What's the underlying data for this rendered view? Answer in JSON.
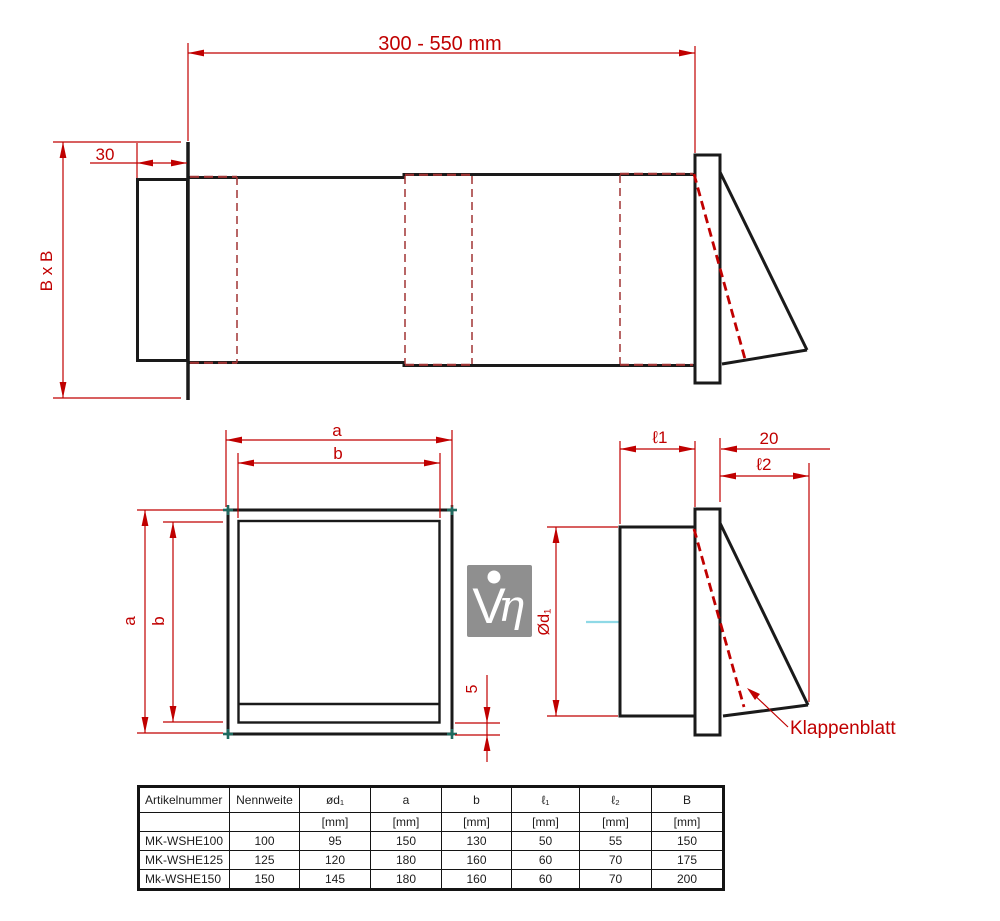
{
  "drawing": {
    "top_view": {
      "length_dim": "300 - 550 mm",
      "flange_dim": "30",
      "duct_dim": "B x B"
    },
    "front_view": {
      "outer_width_dim": "a",
      "inner_width_dim": "b",
      "outer_height_dim": "a",
      "inner_height_dim": "b",
      "gap_dim": "5"
    },
    "side_view": {
      "diameter_dim": "Ød₁",
      "l1_dim": "ℓ1",
      "plate_dim": "20",
      "l2_dim": "ℓ2",
      "flap_label": "Klappenblatt"
    }
  },
  "logo": {
    "letter_v": "V",
    "letter_eta": "η"
  },
  "table": {
    "headers": [
      "Artikelnummer",
      "Nennweite",
      "ød₁",
      "a",
      "b",
      "ℓ₁",
      "ℓ₂",
      "B"
    ],
    "units": [
      "",
      "",
      "[mm]",
      "[mm]",
      "[mm]",
      "[mm]",
      "[mm]",
      "[mm]"
    ],
    "rows": [
      [
        "MK-WSHE100",
        "100",
        "95",
        "150",
        "130",
        "50",
        "55",
        "150"
      ],
      [
        "MK-WSHE125",
        "125",
        "120",
        "180",
        "160",
        "60",
        "70",
        "175"
      ],
      [
        "Mk-WSHE150",
        "150",
        "145",
        "180",
        "160",
        "60",
        "70",
        "200"
      ]
    ]
  },
  "colors": {
    "dimension_red": "#c00000",
    "hidden_line_red": "#a03434",
    "screw_teal": "#1f6a5f",
    "centerline_cyan": "#8fd9e6",
    "logo_gray": "#8f8f8f",
    "line_black": "#1a1a1a"
  }
}
